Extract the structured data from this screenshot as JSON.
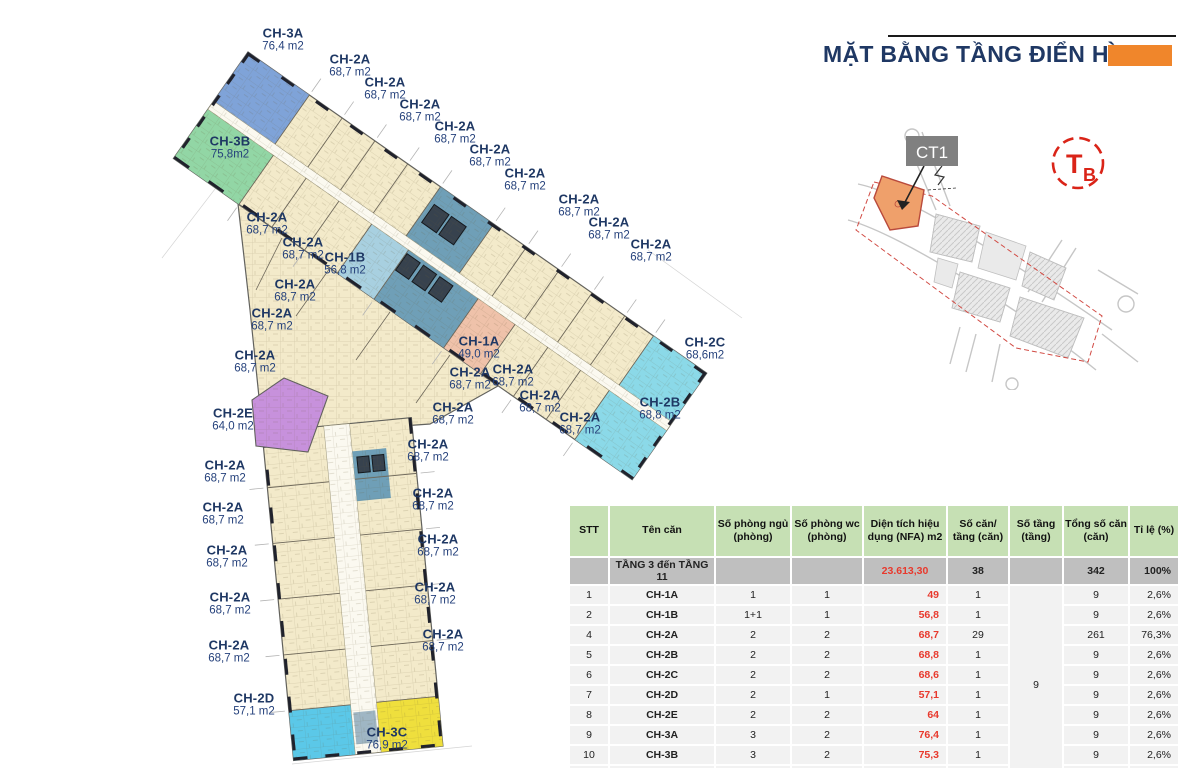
{
  "title": {
    "text": "MẶT BẰNG TẦNG ĐIỂN HÌNH"
  },
  "site_map": {
    "building_label": "CT1"
  },
  "compass": {
    "t": "T",
    "b": "B"
  },
  "colors": {
    "title_navy": "#1F3864",
    "accent_orange": "#F0862B",
    "label_navy": "#1F3864",
    "unit_beige": "#F3EACA",
    "unit_ch3a_blue": "#7FA3D8",
    "unit_ch3b_green": "#92D6A5",
    "unit_ch1b_paleblue": "#A8D0E0",
    "unit_ch1a_salmon": "#EFC2AA",
    "core_teal": "#6F9FB7",
    "unit_ch2b_ch2c_cyan": "#8BD9E8",
    "unit_ch2d_cyan": "#5BC8E8",
    "unit_ch2e_purple": "#C791DC",
    "unit_ch3c_yellow": "#EFDF3D",
    "table_header_green": "#C6E0B4",
    "table_summary_gray": "#BFBFBF",
    "table_row_gray": "#F2F2F2",
    "table_red": "#E8392D",
    "compass_red": "#DA2418",
    "ct1_parcel_orange": "#EFA06B"
  },
  "plan": {
    "labels": [
      {
        "name": "CH-3A",
        "area": "76,4 m2",
        "x": 283,
        "y": 40
      },
      {
        "name": "CH-2A",
        "area": "68,7 m2",
        "x": 350,
        "y": 66
      },
      {
        "name": "CH-2A",
        "area": "68,7 m2",
        "x": 385,
        "y": 89
      },
      {
        "name": "CH-2A",
        "area": "68,7 m2",
        "x": 420,
        "y": 111
      },
      {
        "name": "CH-2A",
        "area": "68,7 m2",
        "x": 455,
        "y": 133
      },
      {
        "name": "CH-2A",
        "area": "68,7 m2",
        "x": 490,
        "y": 156
      },
      {
        "name": "CH-2A",
        "area": "68,7 m2",
        "x": 525,
        "y": 180
      },
      {
        "name": "CH-2A",
        "area": "68,7 m2",
        "x": 579,
        "y": 206
      },
      {
        "name": "CH-2A",
        "area": "68,7 m2",
        "x": 609,
        "y": 229
      },
      {
        "name": "CH-2A",
        "area": "68,7 m2",
        "x": 651,
        "y": 251
      },
      {
        "name": "CH-3B",
        "area": "75,8m2",
        "x": 230,
        "y": 148
      },
      {
        "name": "CH-2A",
        "area": "68,7 m2",
        "x": 267,
        "y": 224
      },
      {
        "name": "CH-2A",
        "area": "68,7 m2",
        "x": 303,
        "y": 249
      },
      {
        "name": "CH-1B",
        "area": "56,8 m2",
        "x": 345,
        "y": 264
      },
      {
        "name": "CH-2A",
        "area": "68,7 m2",
        "x": 295,
        "y": 291
      },
      {
        "name": "CH-2A",
        "area": "68,7 m2",
        "x": 272,
        "y": 320
      },
      {
        "name": "CH-2A",
        "area": "68,7 m2",
        "x": 255,
        "y": 362
      },
      {
        "name": "CH-2E",
        "area": "64,0 m2",
        "x": 233,
        "y": 420
      },
      {
        "name": "CH-1A",
        "area": "49,0 m2",
        "x": 479,
        "y": 348
      },
      {
        "name": "CH-2A",
        "area": "68,7 m2",
        "x": 470,
        "y": 379
      },
      {
        "name": "CH-2A",
        "area": "68,7 m2",
        "x": 513,
        "y": 376
      },
      {
        "name": "CH-2A",
        "area": "68,7 m2",
        "x": 540,
        "y": 402
      },
      {
        "name": "CH-2A",
        "area": "68,7 m2",
        "x": 453,
        "y": 414
      },
      {
        "name": "CH-2A",
        "area": "68,7 m2",
        "x": 580,
        "y": 424
      },
      {
        "name": "CH-2C",
        "area": "68,6m2",
        "x": 705,
        "y": 349
      },
      {
        "name": "CH-2B",
        "area": "68,8 m2",
        "x": 660,
        "y": 409
      },
      {
        "name": "CH-2A",
        "area": "68,7 m2",
        "x": 428,
        "y": 451
      },
      {
        "name": "CH-2A",
        "area": "68,7 m2",
        "x": 225,
        "y": 472
      },
      {
        "name": "CH-2A",
        "area": "68,7 m2",
        "x": 433,
        "y": 500
      },
      {
        "name": "CH-2A",
        "area": "68,7 m2",
        "x": 223,
        "y": 514
      },
      {
        "name": "CH-2A",
        "area": "68,7 m2",
        "x": 438,
        "y": 546
      },
      {
        "name": "CH-2A",
        "area": "68,7 m2",
        "x": 227,
        "y": 557
      },
      {
        "name": "CH-2A",
        "area": "68,7 m2",
        "x": 435,
        "y": 594
      },
      {
        "name": "CH-2A",
        "area": "68,7 m2",
        "x": 230,
        "y": 604
      },
      {
        "name": "CH-2A",
        "area": "68,7 m2",
        "x": 443,
        "y": 641
      },
      {
        "name": "CH-2A",
        "area": "68,7 m2",
        "x": 229,
        "y": 652
      },
      {
        "name": "CH-2D",
        "area": "57,1 m2",
        "x": 254,
        "y": 705
      },
      {
        "name": "CH-3C",
        "area": "76,9 m2",
        "x": 387,
        "y": 739
      }
    ]
  },
  "table": {
    "headers": [
      "STT",
      "Tên căn",
      "Số phòng ngủ (phòng)",
      "Số phòng wc (phòng)",
      "Diện tích hiệu dụng (NFA) m2",
      "Số căn/ tầng (căn)",
      "Số tầng (tầng)",
      "Tổng số căn (căn)",
      "Tỉ lệ (%)"
    ],
    "summary": {
      "stt": "",
      "label": "TẦNG 3 đến TẦNG 11",
      "ngu": "",
      "wc": "",
      "nfa": "23.613,30",
      "can_tang": "38",
      "tang": "",
      "tong": "342",
      "tile": "100%"
    },
    "merged_floors": "9",
    "rows": [
      {
        "stt": "1",
        "ten": "CH-1A",
        "ngu": "1",
        "wc": "1",
        "nfa": "49",
        "can_tang": "1",
        "tong": "9",
        "tile": "2,6%"
      },
      {
        "stt": "2",
        "ten": "CH-1B",
        "ngu": "1+1",
        "wc": "1",
        "nfa": "56,8",
        "can_tang": "1",
        "tong": "9",
        "tile": "2,6%"
      },
      {
        "stt": "4",
        "ten": "CH-2A",
        "ngu": "2",
        "wc": "2",
        "nfa": "68,7",
        "can_tang": "29",
        "tong": "261",
        "tile": "76,3%"
      },
      {
        "stt": "5",
        "ten": "CH-2B",
        "ngu": "2",
        "wc": "2",
        "nfa": "68,8",
        "can_tang": "1",
        "tong": "9",
        "tile": "2,6%"
      },
      {
        "stt": "6",
        "ten": "CH-2C",
        "ngu": "2",
        "wc": "2",
        "nfa": "68,6",
        "can_tang": "1",
        "tong": "9",
        "tile": "2,6%"
      },
      {
        "stt": "7",
        "ten": "CH-2D",
        "ngu": "2",
        "wc": "1",
        "nfa": "57,1",
        "can_tang": "1",
        "tong": "9",
        "tile": "2,6%"
      },
      {
        "stt": "8",
        "ten": "CH-2E",
        "ngu": "2",
        "wc": "2",
        "nfa": "64",
        "can_tang": "1",
        "tong": "9",
        "tile": "2,6%"
      },
      {
        "stt": "9",
        "ten": "CH-3A",
        "ngu": "3",
        "wc": "2",
        "nfa": "76,4",
        "can_tang": "1",
        "tong": "9",
        "tile": "2,6%"
      },
      {
        "stt": "10",
        "ten": "CH-3B",
        "ngu": "3",
        "wc": "2",
        "nfa": "75,3",
        "can_tang": "1",
        "tong": "9",
        "tile": "2,6%"
      },
      {
        "stt": "11",
        "ten": "CH-3C",
        "ngu": "3",
        "wc": "2",
        "nfa": "76,9",
        "can_tang": "1",
        "tong": "9",
        "tile": "2,6%"
      }
    ]
  }
}
